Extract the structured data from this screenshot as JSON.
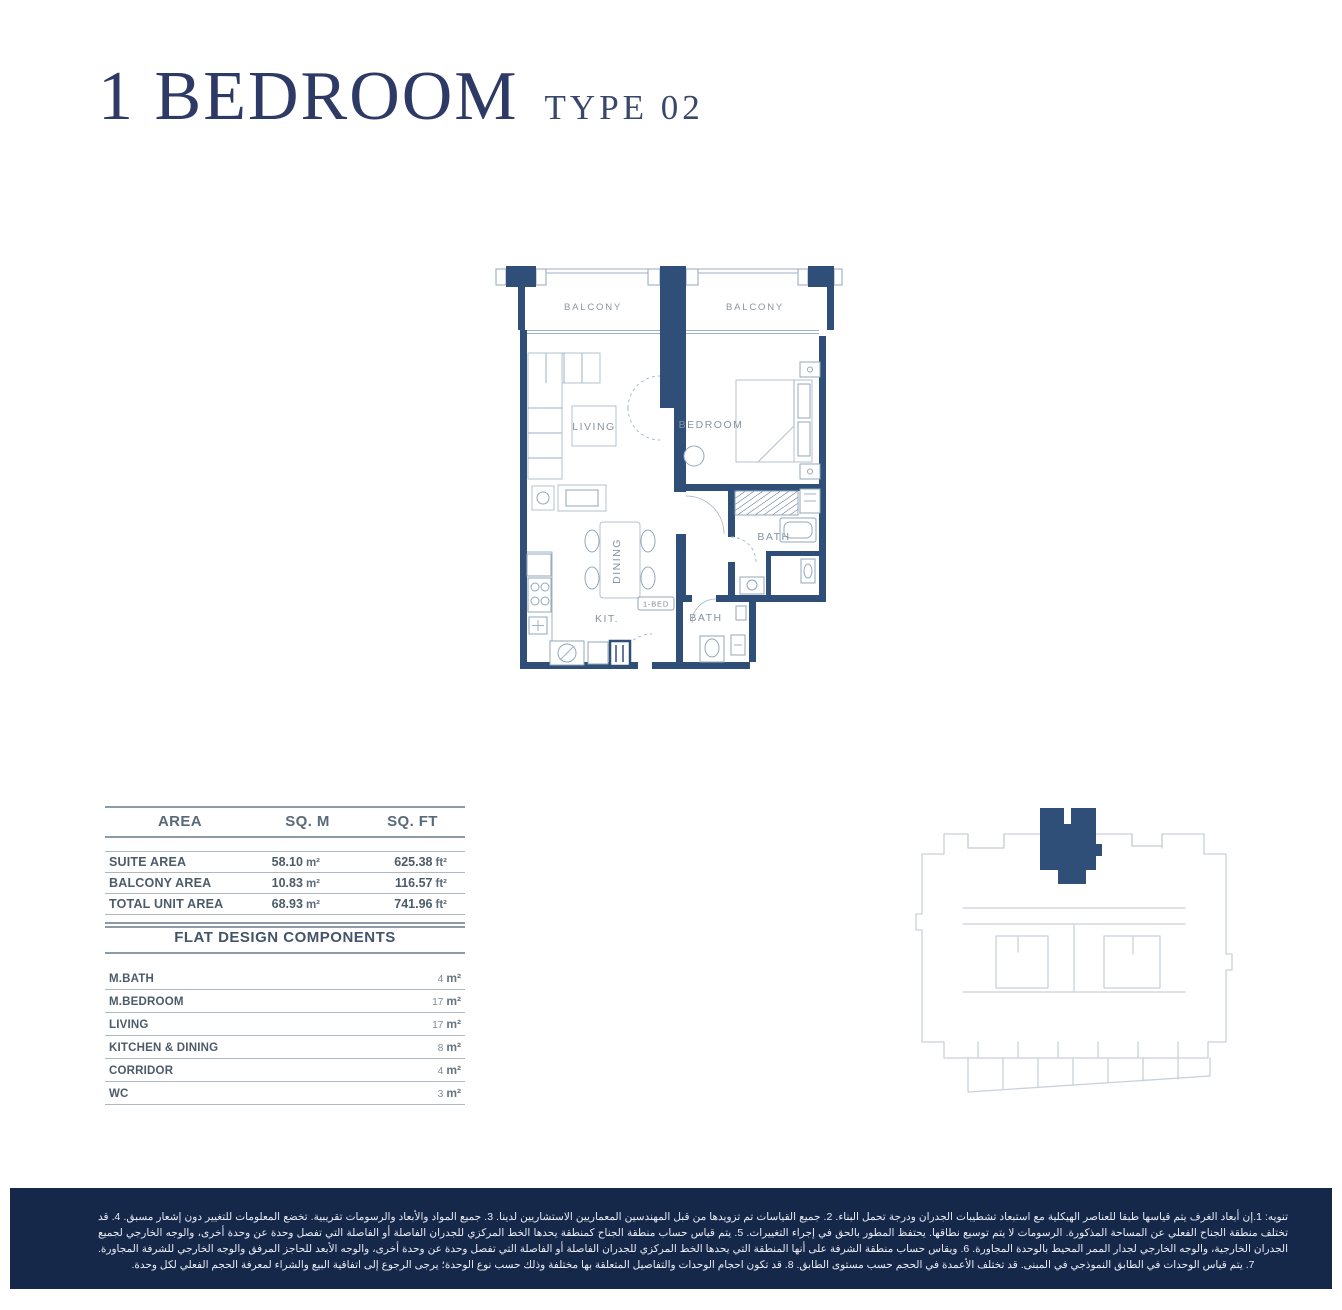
{
  "page": {
    "title_main": "1 BEDROOM",
    "title_type": "TYPE 02"
  },
  "floor_plan": {
    "balcony_left_label": "BALCONY",
    "balcony_right_label": "BALCONY",
    "living_label": "LIVING",
    "bedroom_label": "BEDROOM",
    "dining_label": "DINING",
    "kitchen_label": "KIT.",
    "bath_upper_label": "BATH",
    "bath_lower_label": "BATH",
    "unit_tag": "1-BED"
  },
  "area_table": {
    "headers": {
      "area": "AREA",
      "sqm": "SQ. M",
      "sqft": "SQ. FT"
    },
    "rows": [
      {
        "label": "SUITE AREA",
        "sqm_value": "58.10",
        "sqm_unit": "m²",
        "sqft_value": "625.38",
        "sqft_unit": "ft²"
      },
      {
        "label": "BALCONY AREA",
        "sqm_value": "10.83",
        "sqm_unit": "m²",
        "sqft_value": "116.57",
        "sqft_unit": "ft²"
      },
      {
        "label": "TOTAL UNIT AREA",
        "sqm_value": "68.93",
        "sqm_unit": "m²",
        "sqft_value": "741.96",
        "sqft_unit": "ft²"
      }
    ]
  },
  "components": {
    "title": "FLAT DESIGN COMPONENTS",
    "rows": [
      {
        "label": "M.BATH",
        "value": "4",
        "unit": "m²"
      },
      {
        "label": "M.BEDROOM",
        "value": "17",
        "unit": "m²"
      },
      {
        "label": "LIVING",
        "value": "17",
        "unit": "m²"
      },
      {
        "label": "KITCHEN & DINING",
        "value": "8",
        "unit": "m²"
      },
      {
        "label": "CORRIDOR",
        "value": "4",
        "unit": "m²"
      },
      {
        "label": "WC",
        "value": "3",
        "unit": "m²"
      }
    ]
  },
  "disclaimer": {
    "text": "تنويه: 1.إن أبعاد الغرف يتم قياسها طبقا للعناصر الهيكلية مع استبعاد تشطيبات الجدران ودرجة تحمل البناء. 2. جميع القياسات تم تزويدها من قبل المهندسين المعماريين الاستشاريين لدينا. 3. جميع المواد والأبعاد والرسومات تقريبية. تخضع المعلومات للتغيير دون إشعار مسبق. 4. قد تختلف منطقة الجناح الفعلي عن المساحة المذكورة. الرسومات لا يتم توسيع نطاقها. يحتفظ المطور بالحق في إجراء التغييرات. 5. يتم قياس حساب منطقة الجناح كمنطقة يحدها الخط المركزي للجدران الفاصلة أو الفاصلة التي تفصل وحدة عن وحدة أخرى، والوجه الخارجي لجميع الجدران الخارجية، والوجه الخارجي لجدار الممر المحيط بالوحدة المجاورة. 6. ويقاس حساب منطقة الشرفة على أنها المنطقة التي يحدها الخط المركزي للجدران الفاصلة أو الفاصلة التي تفصل وحدة عن وحدة أخرى، والوجه الأبعد للحاجز المرفق والوجه الخارجي للشرفة المجاورة. 7. يتم قياس الوحدات في الطابق النموذجي في المبنى. قد تختلف الأعمدة في الحجم حسب مستوى الطابق. 8. قد تكون احجام الوحدات والتفاصيل المتعلقة بها مختلفة وذلك حسب نوع الوحدة؛ يرجى الرجوع إلى اتفاقية البيع والشراء لمعرفة الحجم الفعلي لكل وحدة."
  },
  "colors": {
    "wall_navy": "#2f4e78",
    "title_navy": "#2e3a66",
    "band_navy": "#16284a",
    "label_gray": "#8693a1",
    "line_gray": "#9aa7b2"
  }
}
